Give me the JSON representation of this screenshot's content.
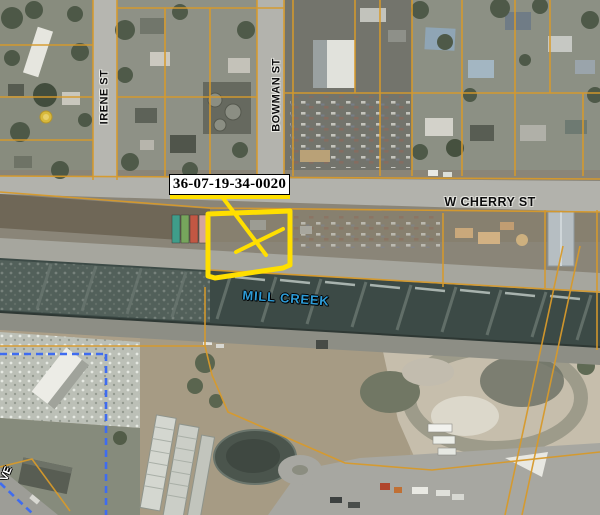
{
  "map": {
    "labels": {
      "parcel_id": "36-07-19-34-0020",
      "street_irene": "IRENE ST",
      "street_bowman": "BOWMAN ST",
      "street_cherry": "W CHERRY ST",
      "creek": "MILL CREEK",
      "partial_street": "VE"
    },
    "colors": {
      "parcel_line": "#d79a2b",
      "highlight_yellow": "#ffdf00",
      "city_limit_blue": "#3f6cf0",
      "creek_label_blue": "#2d9bd6",
      "water_dark": "#3c4a46",
      "label_background": "#ffffff",
      "label_text": "#000000"
    }
  }
}
